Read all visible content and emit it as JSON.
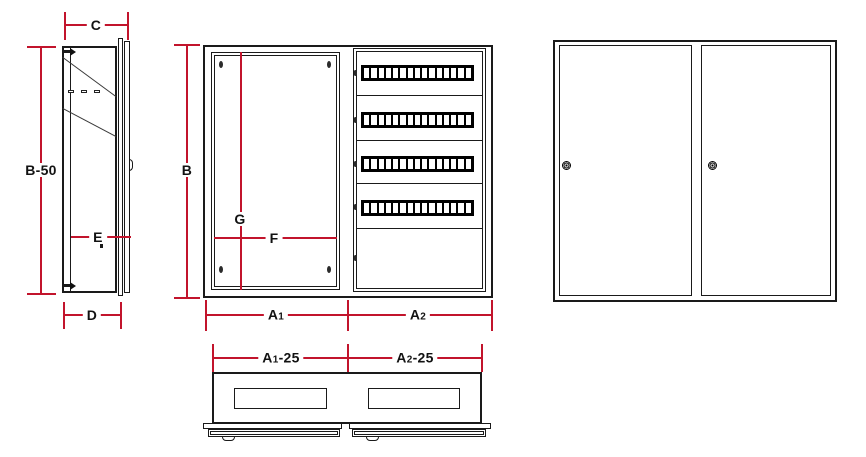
{
  "colors": {
    "dimension_line": "#c2142c",
    "drawing_line": "#1a1a1a",
    "background": "#ffffff"
  },
  "dims": {
    "c": {
      "label": "C"
    },
    "b50": {
      "label": "B-50"
    },
    "e": {
      "label": "E"
    },
    "d": {
      "label": "D"
    },
    "b": {
      "label": "B"
    },
    "g": {
      "label": "G"
    },
    "f": {
      "label": "F"
    },
    "a1": {
      "base": "A",
      "sub": "1",
      "suffix": ""
    },
    "a2": {
      "base": "A",
      "sub": "2",
      "suffix": ""
    },
    "a1_25": {
      "base": "A",
      "sub": "1",
      "suffix": "-25"
    },
    "a2_25": {
      "base": "A",
      "sub": "2",
      "suffix": "-25"
    }
  },
  "front_open": {
    "terminal_row_count": 4,
    "modules_per_row": 15,
    "hinge_mark_count": 5,
    "panel_screw_count": 4
  },
  "front_closed": {
    "door_count": 2,
    "lock_count": 2
  },
  "top_view": {
    "cutout_count": 2,
    "door_strip_count": 2
  }
}
